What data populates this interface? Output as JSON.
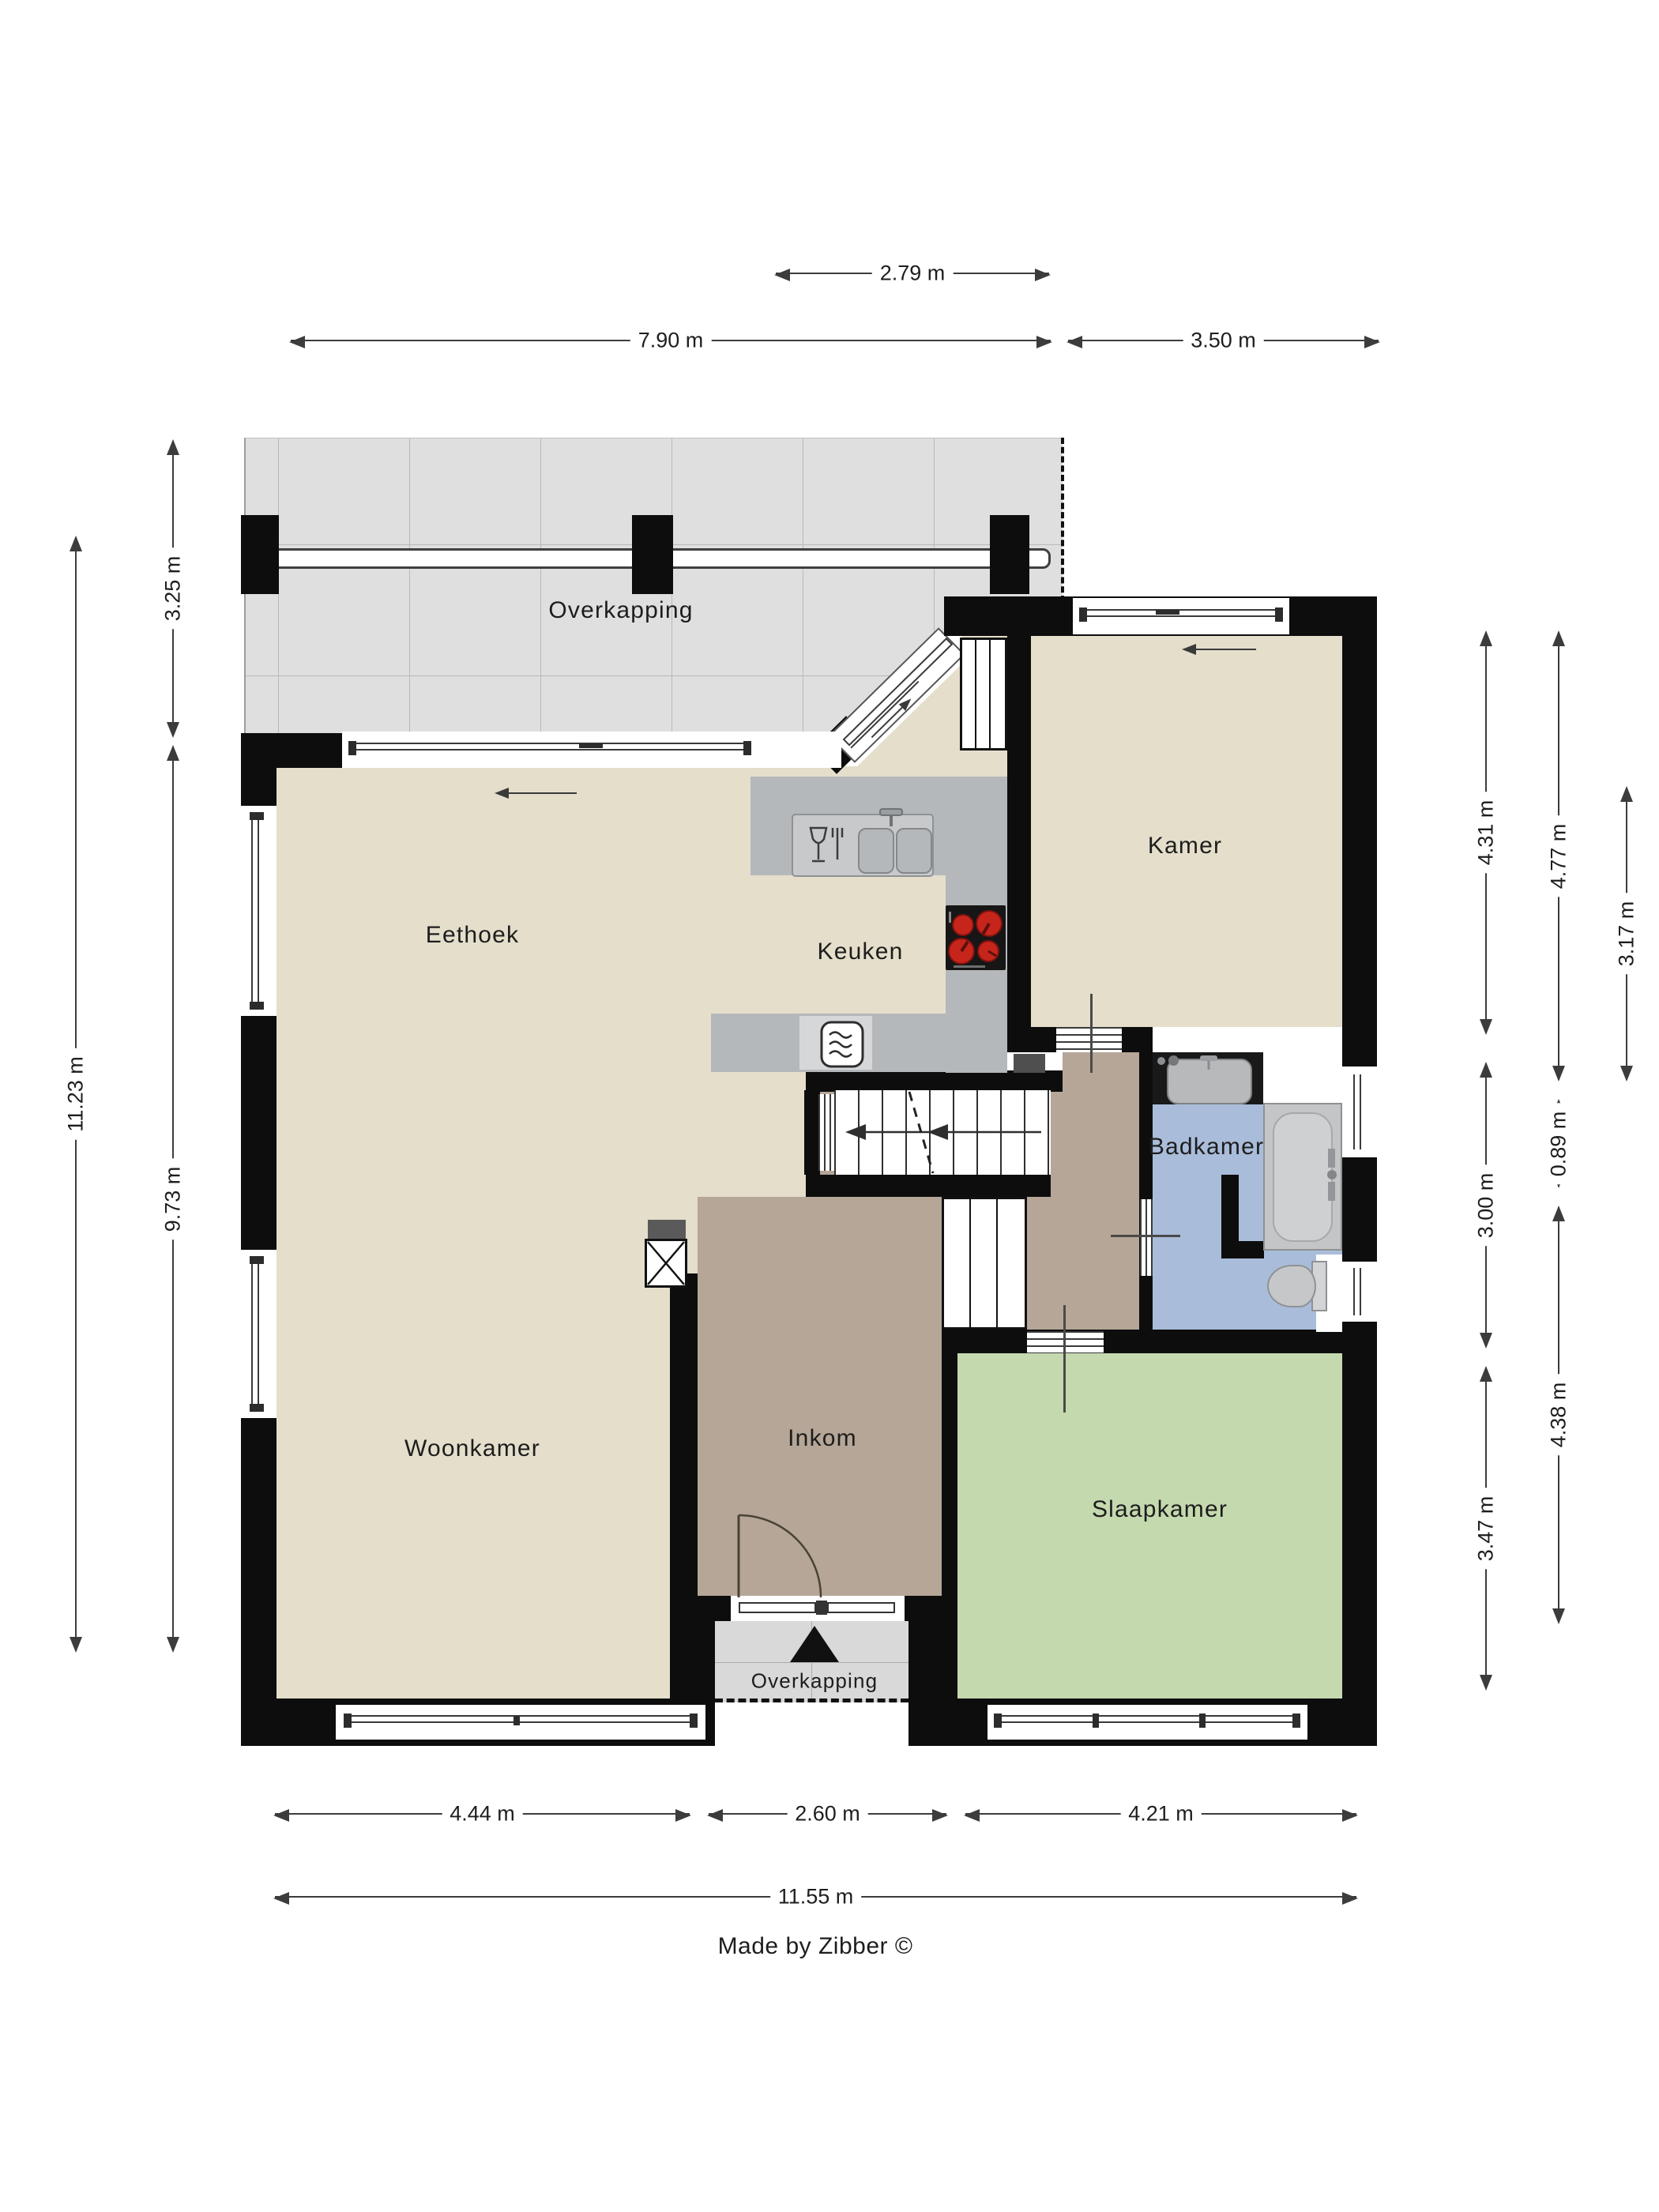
{
  "title": "Floor plan (begane grond)",
  "rooms": {
    "overkapping_top": "Overkapping",
    "eethoek": "Eethoek",
    "keuken": "Keuken",
    "kamer": "Kamer",
    "badkamer": "Badkamer",
    "woonkamer": "Woonkamer",
    "inkom": "Inkom",
    "slaapkamer": "Slaapkamer",
    "overkapping_bottom": "Overkapping"
  },
  "dimensions": {
    "top": [
      {
        "label": "2.79 m"
      },
      {
        "label": "7.90 m"
      },
      {
        "label": "3.50 m"
      }
    ],
    "left": [
      {
        "label": "11.23 m"
      },
      {
        "label": "3.25 m"
      },
      {
        "label": "9.73 m"
      }
    ],
    "right": [
      {
        "label": "4.31 m"
      },
      {
        "label": "3.00 m"
      },
      {
        "label": "3.47 m"
      },
      {
        "label": "4.77 m"
      },
      {
        "label": "0.89 m"
      },
      {
        "label": "4.38 m"
      },
      {
        "label": "3.17 m"
      }
    ],
    "bottom": [
      {
        "label": "4.44 m"
      },
      {
        "label": "2.60 m"
      },
      {
        "label": "4.21 m"
      },
      {
        "label": "11.55 m"
      }
    ]
  },
  "footer": {
    "credit": "Made by Zibber ©"
  },
  "colors": {
    "wall": "#0d0d0d",
    "living_floor": "#e4decb",
    "hall_floor": "#b5a697",
    "bedroom_floor": "#c5d9ae",
    "bathroom_floor": "#a9bdda",
    "terrace_tile": "#dfdfdf",
    "counter_gray": "#b5b8bb",
    "burner_red": "#c6251c"
  },
  "icons": {
    "stove": "stove-burners-icon",
    "sink": "kitchen-sink-icon",
    "dishwasher": "glass-fork-icon",
    "microwave": "microwave-icon",
    "bathtub": "bathtub-icon",
    "toilet": "toilet-icon",
    "washbasin": "washbasin-icon",
    "entrance": "entrance-triangle-icon",
    "stairs": "stairs-arrow-icon"
  }
}
